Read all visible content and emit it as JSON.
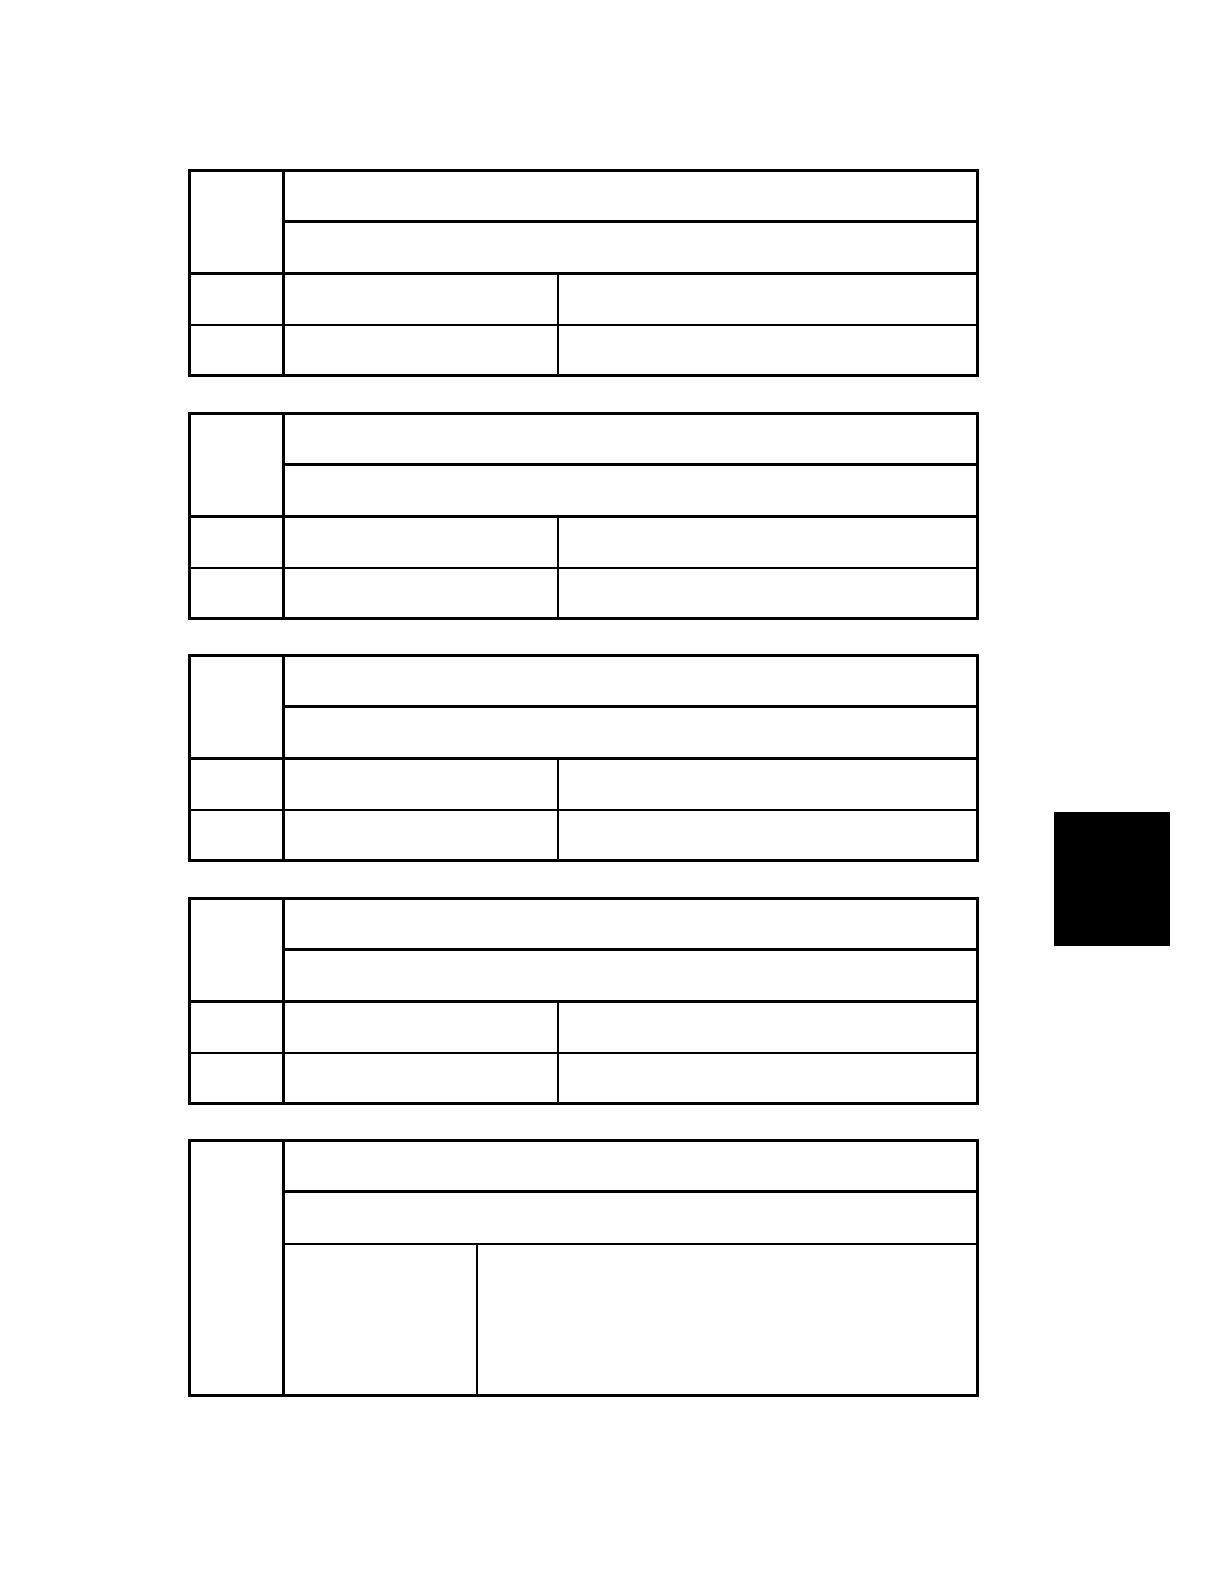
{
  "page": {
    "background_color": "#ffffff",
    "content": "blank scanned manual page with five empty specification tables"
  },
  "colors": {
    "table_border": "#000000",
    "side_marker": "#000000",
    "footer_link_underline": "#000080"
  },
  "tables": [
    {
      "name": "spec-table-1",
      "cells": {
        "label_col": "",
        "header_row_1": "",
        "header_row_2": "",
        "row3_label": "",
        "row3_mid": "",
        "row3_right": "",
        "row4_label": "",
        "row4_mid": "",
        "row4_right": ""
      }
    },
    {
      "name": "spec-table-2",
      "cells": {
        "label_col": "",
        "header_row_1": "",
        "header_row_2": "",
        "row3_label": "",
        "row3_mid": "",
        "row3_right": "",
        "row4_label": "",
        "row4_mid": "",
        "row4_right": ""
      }
    },
    {
      "name": "spec-table-3",
      "cells": {
        "label_col": "",
        "header_row_1": "",
        "header_row_2": "",
        "row3_label": "",
        "row3_mid": "",
        "row3_right": "",
        "row4_label": "",
        "row4_mid": "",
        "row4_right": ""
      }
    },
    {
      "name": "spec-table-4",
      "cells": {
        "label_col": "",
        "header_row_1": "",
        "header_row_2": "",
        "row3_label": "",
        "row3_mid": "",
        "row3_right": "",
        "row4_label": "",
        "row4_mid": "",
        "row4_right": ""
      }
    },
    {
      "name": "spec-table-5",
      "cells": {
        "label_col": "",
        "header_row_1": "",
        "header_row_2": "",
        "row3_left": "",
        "row3_right": ""
      }
    }
  ],
  "footer": {
    "link_label": ""
  }
}
